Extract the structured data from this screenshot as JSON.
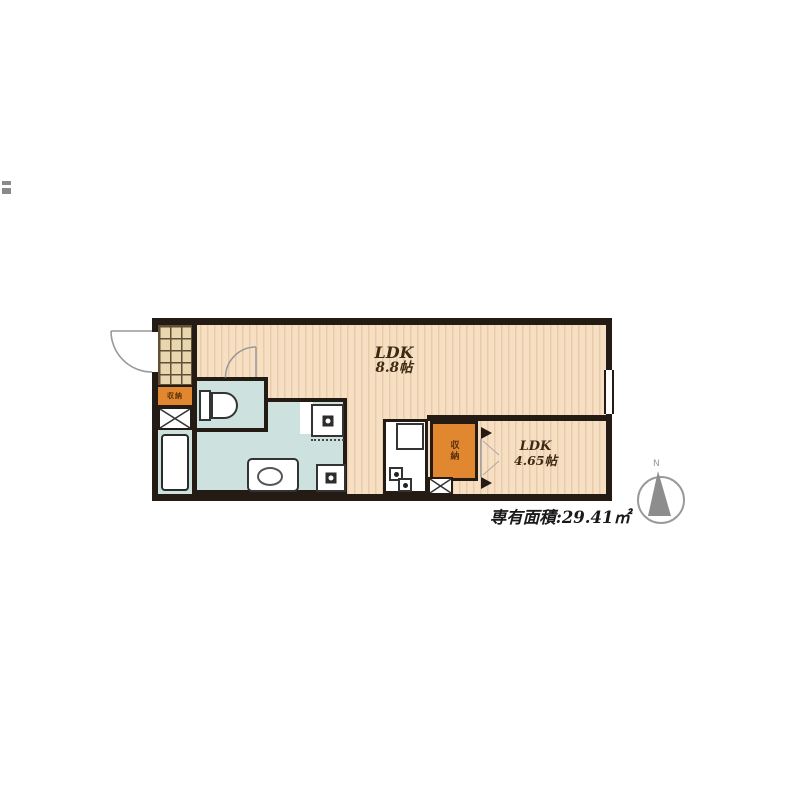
{
  "rooms": {
    "ldk": {
      "label": "LDK",
      "size": "8.8帖"
    },
    "room2": {
      "label": "LDK",
      "size": "4.65帖"
    }
  },
  "storage": {
    "closet_label": "収納",
    "entry_cabinet_label": "収納"
  },
  "area_text": "専有面積:29.41㎡",
  "compass": {
    "north_label": "N"
  },
  "colors": {
    "wall": "#241b15",
    "floor": "#f7dfc3",
    "floor_stripe": "#e8cba8",
    "wet_area": "#cde2df",
    "storage_orange": "#e0872f",
    "entrance_tile": "#e9d5ae",
    "door_arc": "#999999",
    "compass_gray": "#8d8d8d"
  }
}
